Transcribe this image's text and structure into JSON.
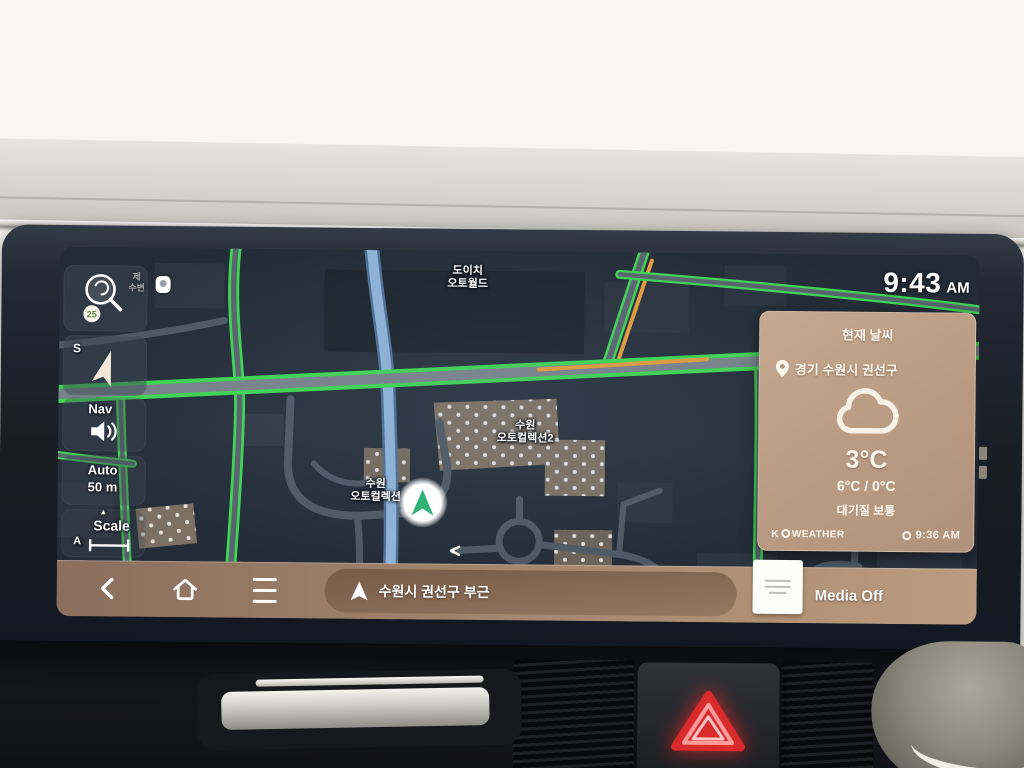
{
  "status": {
    "time": "9:43",
    "meridiem": "AM"
  },
  "sidebar": {
    "gs25_badge": "25",
    "compass_heading": "S",
    "nav_label": "Nav",
    "zoom_mode": "Auto",
    "zoom_scale": "50 m",
    "scale_marker_arrow": "▲",
    "scale_label": "Scale",
    "scale_marker": "A"
  },
  "map": {
    "labels": {
      "poi1_line1": "도이치",
      "poi1_line2": "오토월드",
      "poi2_line1": "수원",
      "poi2_line2": "오토컬렉션2",
      "poi3_line1": "수원",
      "poi3_line2": "오토컬렉션",
      "poi4_line1": "제",
      "poi4_line2": "수변"
    }
  },
  "weather": {
    "title": "현재 날씨",
    "location": "경기 수원시 권선구",
    "temperature": "3°C",
    "high_low": "6°C / 0°C",
    "air_quality": "대기질 보통",
    "provider_prefix": "K",
    "provider_suffix": "WEATHER",
    "updated_time": "9:36 AM"
  },
  "bottom_bar": {
    "destination": "수원시 권선구 부근",
    "media_status": "Media Off"
  },
  "colors": {
    "traffic_green": "#3ed653",
    "traffic_orange": "#e59b3d",
    "widget_tan": "#bb9c87",
    "bar_brown": "#a9896f",
    "hazard_red": "#e23030"
  }
}
